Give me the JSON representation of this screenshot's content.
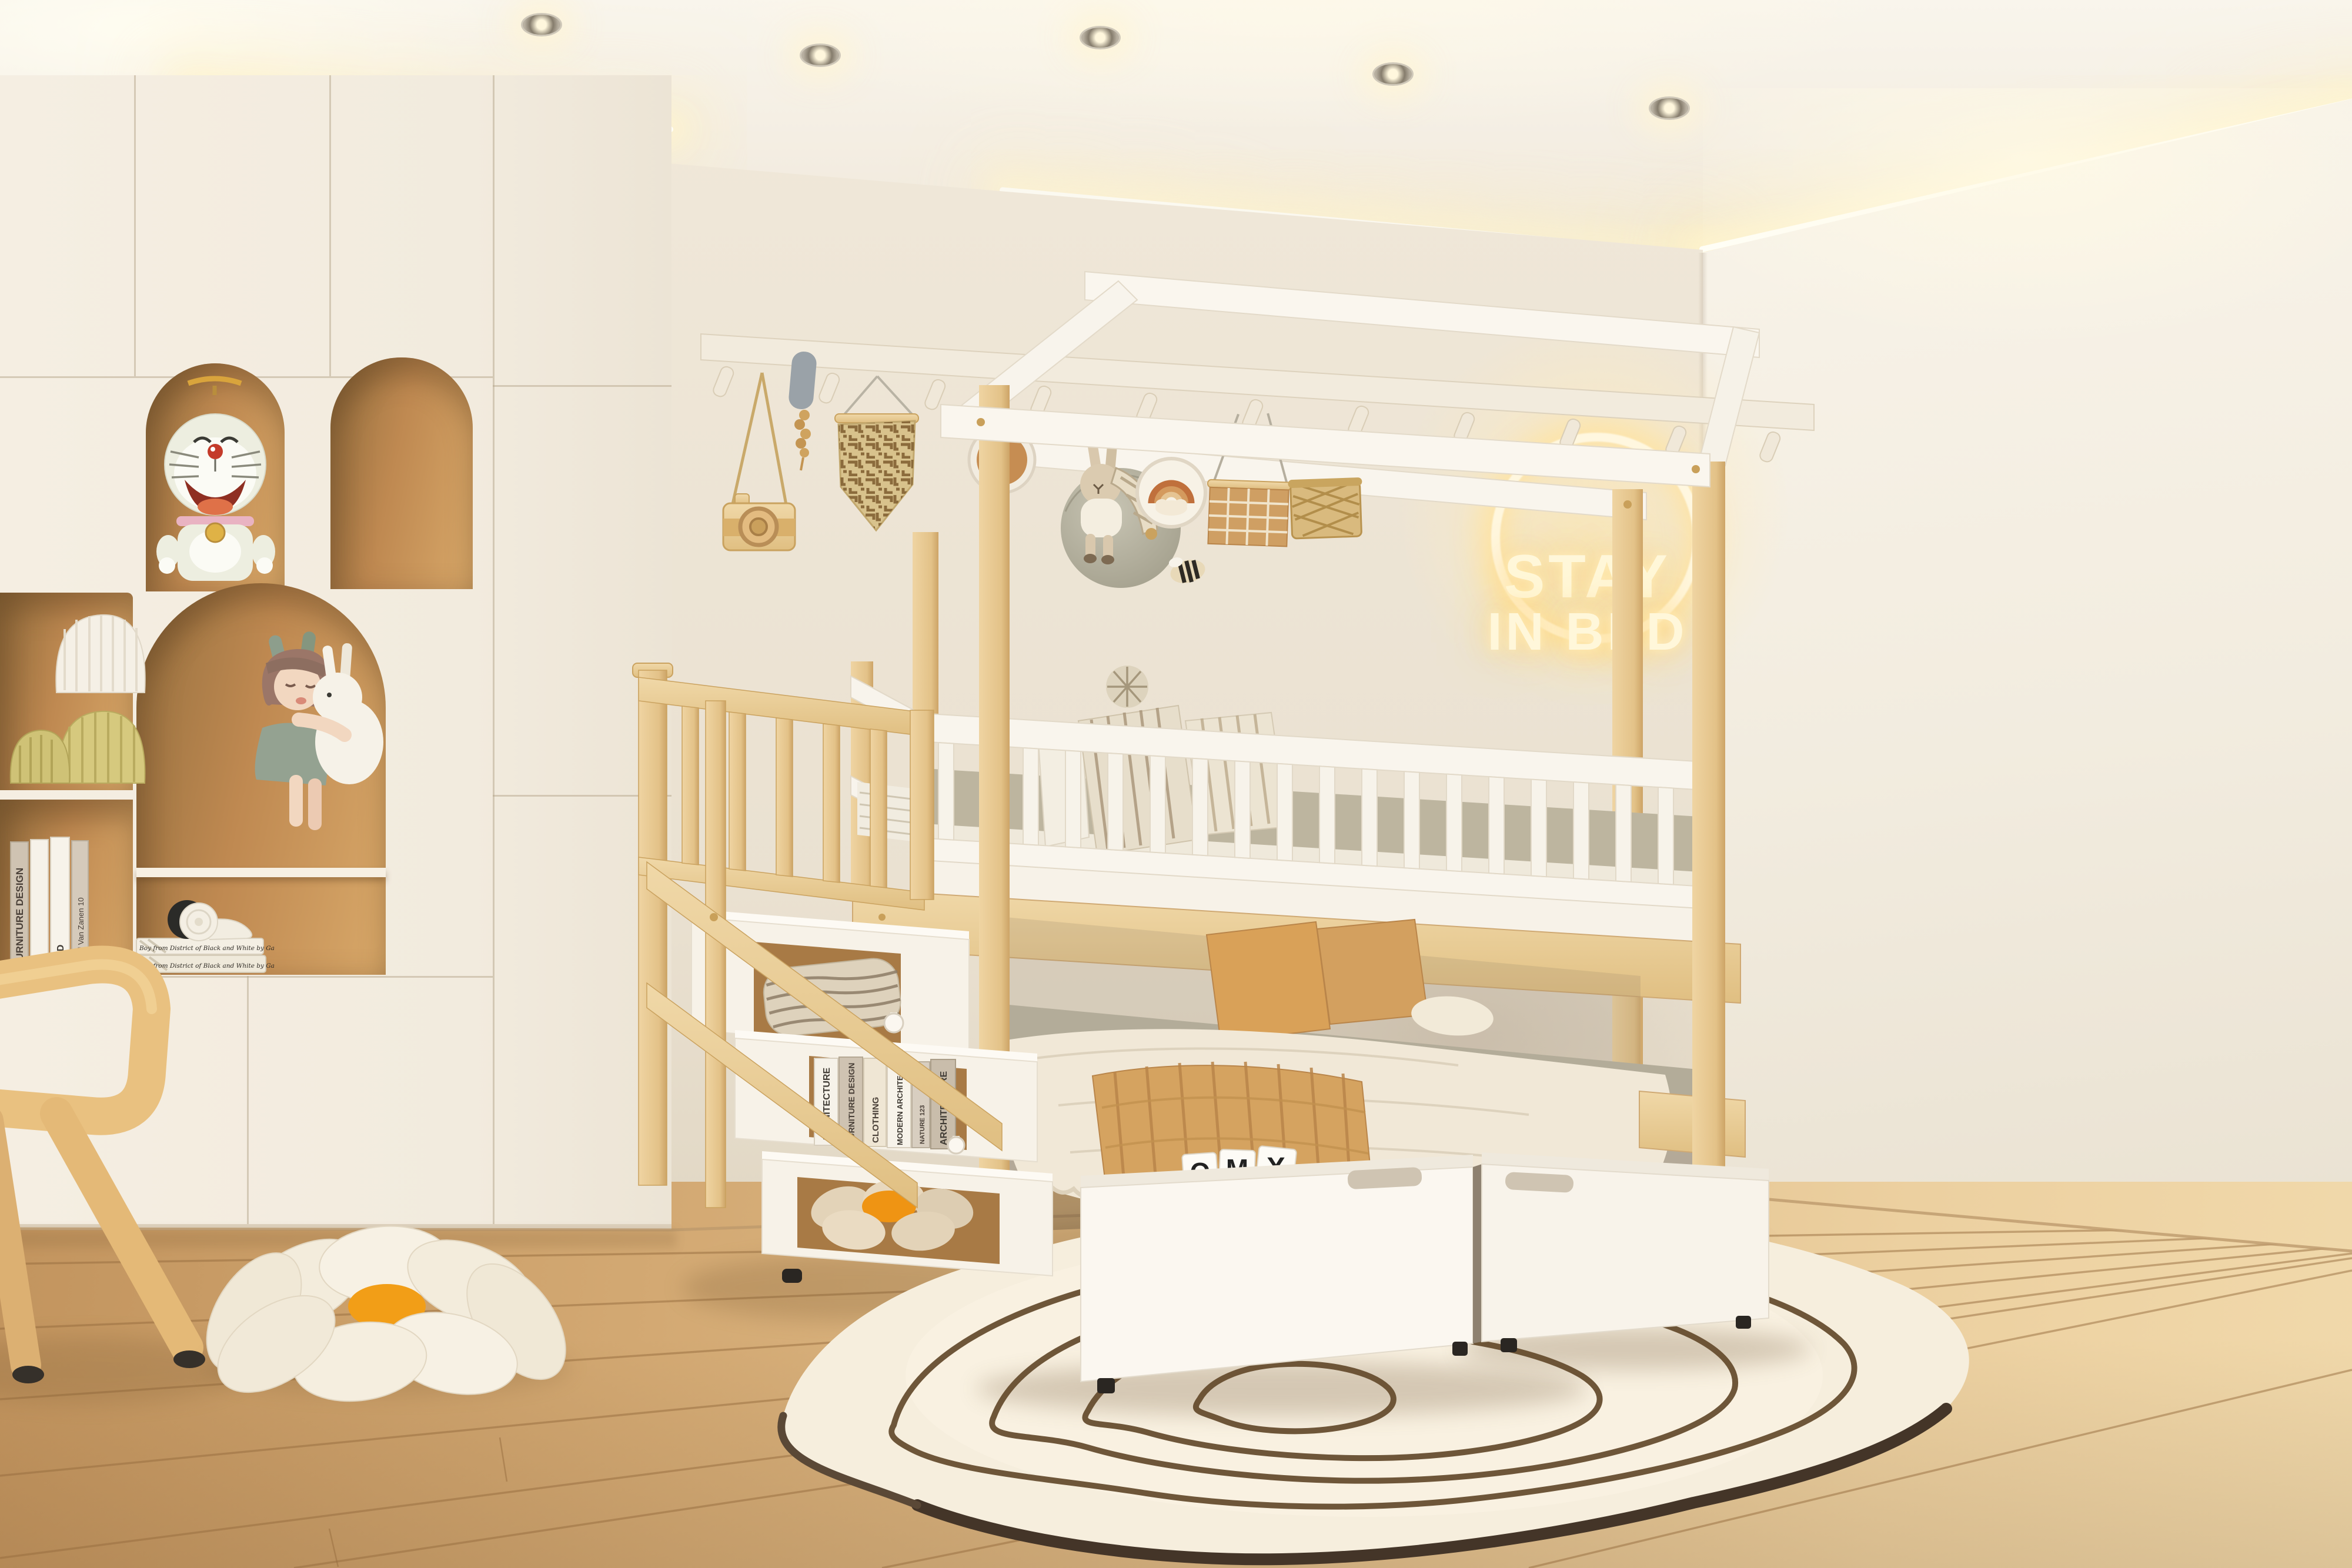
{
  "window": {
    "title": "Kids bedroom 3D render",
    "description": "Children's bedroom with natural-wood house-frame bunk bed, storage staircase with bookshelf cubbies, cream built-in arched shelving with figurines, glowing circular neon sign, under-bed drawers, topographic-pattern rug on light oak floor"
  },
  "neon_sign": {
    "line1": "STAY",
    "line2": "IN BED",
    "glow_color": "#ffe9b0"
  },
  "letter_blocks": {
    "letters": [
      "O",
      "M",
      "X"
    ]
  },
  "books": {
    "stair_shelf": [
      "ARCHITECTURE",
      "FURNITURE DESIGN",
      "CLOTHING",
      "MODERN ARCHITECTURE",
      "NATURE 123",
      "ARCHITECTURE"
    ],
    "left_shelf": [
      "FURNITURE DESIGN",
      "",
      "MOD",
      "David Van Zanen 10"
    ],
    "headphone_stack": [
      "Boy from District of Black and White by Ga",
      "Boy from District of Black and White by Ga"
    ]
  },
  "palette": {
    "wall": "#ece3d4",
    "pine_wood": "#e7cb97",
    "white_paint": "#f8f4ec",
    "niche_caramel": "#c08a52",
    "camel_textile": "#d5a360",
    "mattress_sage": "#b9b3a0",
    "rug_base": "#f6eedd",
    "rug_line": "#6e5639",
    "rug_edge": "#443528",
    "floor_oak": "#d9b488",
    "neon": "#fff7da",
    "daisy_center": "#f29b1d"
  }
}
